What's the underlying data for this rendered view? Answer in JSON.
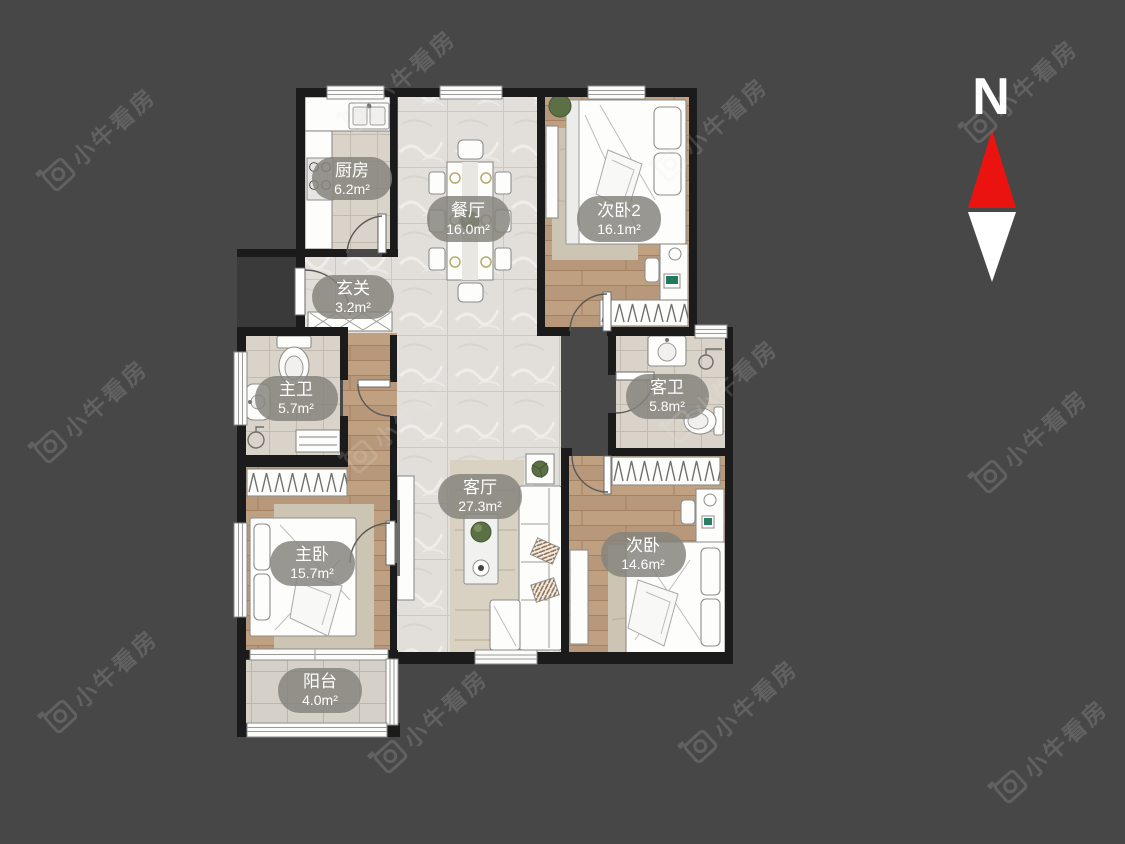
{
  "app": {
    "kind": "real-estate-floorplan-view"
  },
  "background_color": "#474747",
  "watermark": {
    "text": "小牛看房",
    "icon": "camera-logo-icon"
  },
  "compass": {
    "label": "N",
    "north_arrow_color": "#ea1310",
    "south_arrow_color": "#ffffff"
  },
  "floorplan": {
    "wall_color": "#1b1b1b",
    "label_pill_color": "#84837c",
    "rooms": [
      {
        "id": "kitchen",
        "name": "厨房",
        "area": "6.2m²"
      },
      {
        "id": "dining-room",
        "name": "餐厅",
        "area": "16.0m²"
      },
      {
        "id": "bedroom-2-upper",
        "name": "次卧2",
        "area": "16.1m²"
      },
      {
        "id": "entryway",
        "name": "玄关",
        "area": "3.2m²"
      },
      {
        "id": "master-bathroom",
        "name": "主卫",
        "area": "5.7m²"
      },
      {
        "id": "guest-bathroom",
        "name": "客卫",
        "area": "5.8m²"
      },
      {
        "id": "living-room",
        "name": "客厅",
        "area": "27.3m²"
      },
      {
        "id": "master-bedroom",
        "name": "主卧",
        "area": "15.7m²"
      },
      {
        "id": "second-bedroom",
        "name": "次卧",
        "area": "14.6m²"
      },
      {
        "id": "balcony",
        "name": "阳台",
        "area": "4.0m²"
      }
    ]
  }
}
